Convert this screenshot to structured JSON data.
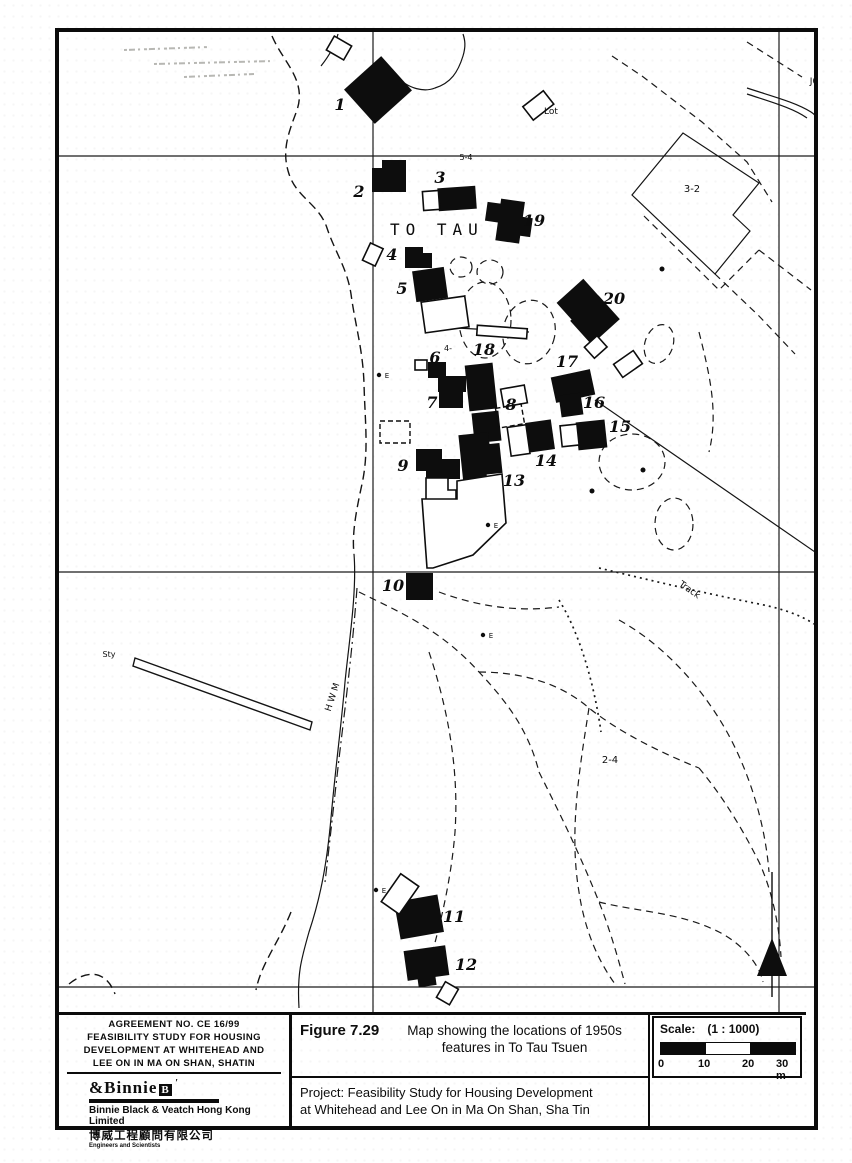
{
  "agreement": {
    "lines": [
      "AGREEMENT NO. CE 16/99",
      "FEASIBILITY STUDY FOR HOUSING",
      "DEVELOPMENT AT WHITEHEAD AND",
      "LEE ON IN MA ON SHAN, SHATIN"
    ]
  },
  "company": {
    "logo_text": "&Binnie",
    "logo_badge": "B",
    "name": "Binnie Black &  Veatch Hong Kong Limited",
    "chinese_name": "博威工程顧問有限公司",
    "tagline": "Engineers and Scientists"
  },
  "figure": {
    "label": "Figure 7.29",
    "caption_line1": "Map showing the locations of 1950s",
    "caption_line2": "features in To Tau Tsuen"
  },
  "project": {
    "line1": "Project:  Feasibility Study for Housing Development",
    "line2": "at Whitehead and Lee On in Ma On Shan, Sha Tin"
  },
  "scale": {
    "label": "Scale:",
    "ratio": "(1 : 1000)",
    "ticks": [
      "0",
      "10",
      "20",
      "30 m"
    ]
  },
  "map": {
    "village_label": "TO TAU",
    "feature_numbers": [
      {
        "n": "1",
        "x": 281,
        "y": 78
      },
      {
        "n": "2",
        "x": 300,
        "y": 165
      },
      {
        "n": "3",
        "x": 381,
        "y": 151
      },
      {
        "n": "4",
        "x": 333,
        "y": 228
      },
      {
        "n": "5",
        "x": 343,
        "y": 262
      },
      {
        "n": "6",
        "x": 376,
        "y": 331
      },
      {
        "n": "7",
        "x": 373,
        "y": 376
      },
      {
        "n": "8",
        "x": 452,
        "y": 378
      },
      {
        "n": "9",
        "x": 344,
        "y": 439
      },
      {
        "n": "10",
        "x": 334,
        "y": 559
      },
      {
        "n": "11",
        "x": 395,
        "y": 890
      },
      {
        "n": "12",
        "x": 407,
        "y": 938
      },
      {
        "n": "13",
        "x": 455,
        "y": 454
      },
      {
        "n": "14",
        "x": 487,
        "y": 434
      },
      {
        "n": "15",
        "x": 561,
        "y": 400
      },
      {
        "n": "16",
        "x": 535,
        "y": 376
      },
      {
        "n": "17",
        "x": 508,
        "y": 335
      },
      {
        "n": "18",
        "x": 425,
        "y": 323
      },
      {
        "n": "19",
        "x": 475,
        "y": 194
      },
      {
        "n": "20",
        "x": 555,
        "y": 272
      }
    ],
    "text_labels": [
      {
        "t": "Lot",
        "x": 492,
        "y": 82,
        "s": 9,
        "r": 0
      },
      {
        "t": "J0",
        "x": 755,
        "y": 52,
        "s": 9,
        "r": 0
      },
      {
        "t": "3-2",
        "x": 633,
        "y": 160,
        "s": 10,
        "r": 0
      },
      {
        "t": "2-4",
        "x": 551,
        "y": 731,
        "s": 10,
        "r": 0
      },
      {
        "t": "Track",
        "x": 629,
        "y": 560,
        "s": 9,
        "r": 35
      },
      {
        "t": "H W M",
        "x": 276,
        "y": 666,
        "s": 9,
        "r": -72
      },
      {
        "t": "Sty",
        "x": 50,
        "y": 625,
        "s": 8,
        "r": 0
      },
      {
        "t": "5-4",
        "x": 407,
        "y": 128,
        "s": 8,
        "r": 0
      },
      {
        "t": "4-",
        "x": 389,
        "y": 319,
        "s": 8,
        "r": 0
      },
      {
        "t": "E",
        "x": 328,
        "y": 346,
        "s": 7,
        "r": 0
      },
      {
        "t": "E",
        "x": 437,
        "y": 496,
        "s": 7,
        "r": 0
      },
      {
        "t": "E",
        "x": 432,
        "y": 606,
        "s": 7,
        "r": 0
      },
      {
        "t": "E",
        "x": 325,
        "y": 861,
        "s": 7,
        "r": 0
      }
    ]
  },
  "colors": {
    "ink": "#0d0d0d",
    "paper": "#ffffff"
  }
}
